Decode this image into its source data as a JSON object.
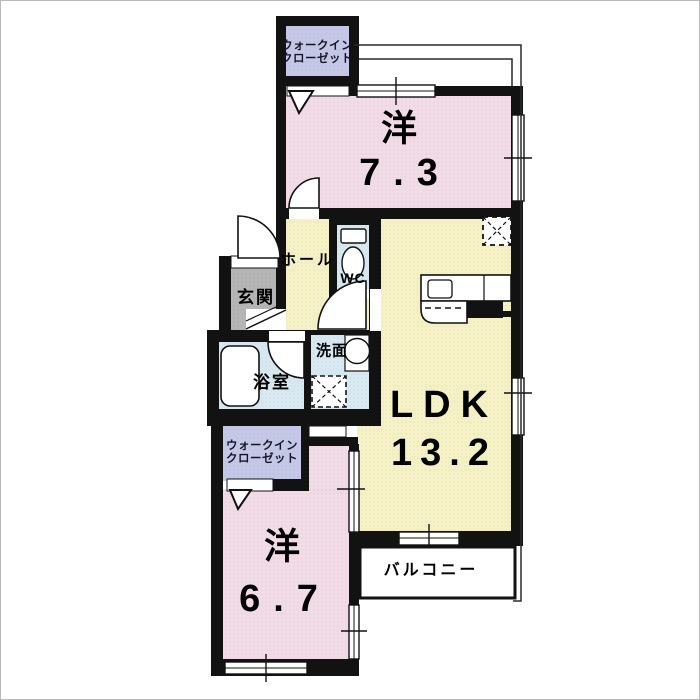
{
  "floor_plan": {
    "labels": {
      "wic1_line1": "ウォークイン",
      "wic1_line2": "クローゼット",
      "room1_name": "洋",
      "room1_size": "7.3",
      "hall": "ホール",
      "wc": "WC",
      "entrance": "玄関",
      "bath": "浴室",
      "wash": "洗面",
      "ldk_name": "LDK",
      "ldk_size": "13.2",
      "balcony": "バルコニー",
      "wic2_line1": "ウォークイン",
      "wic2_line2": "クローゼット",
      "room2_name": "洋",
      "room2_size": "6.7"
    },
    "colors": {
      "room_pink": "#f2dce8",
      "ldk_yellow": "#f6f2c6",
      "closet_purple": "#c6c8e8",
      "wet_blue": "#d8e9f1",
      "entrance_gray": "#b6b6b6",
      "wall_black": "#121212",
      "balcony_white": "#ffffff",
      "outline_gray": "#2a2a2a"
    }
  }
}
